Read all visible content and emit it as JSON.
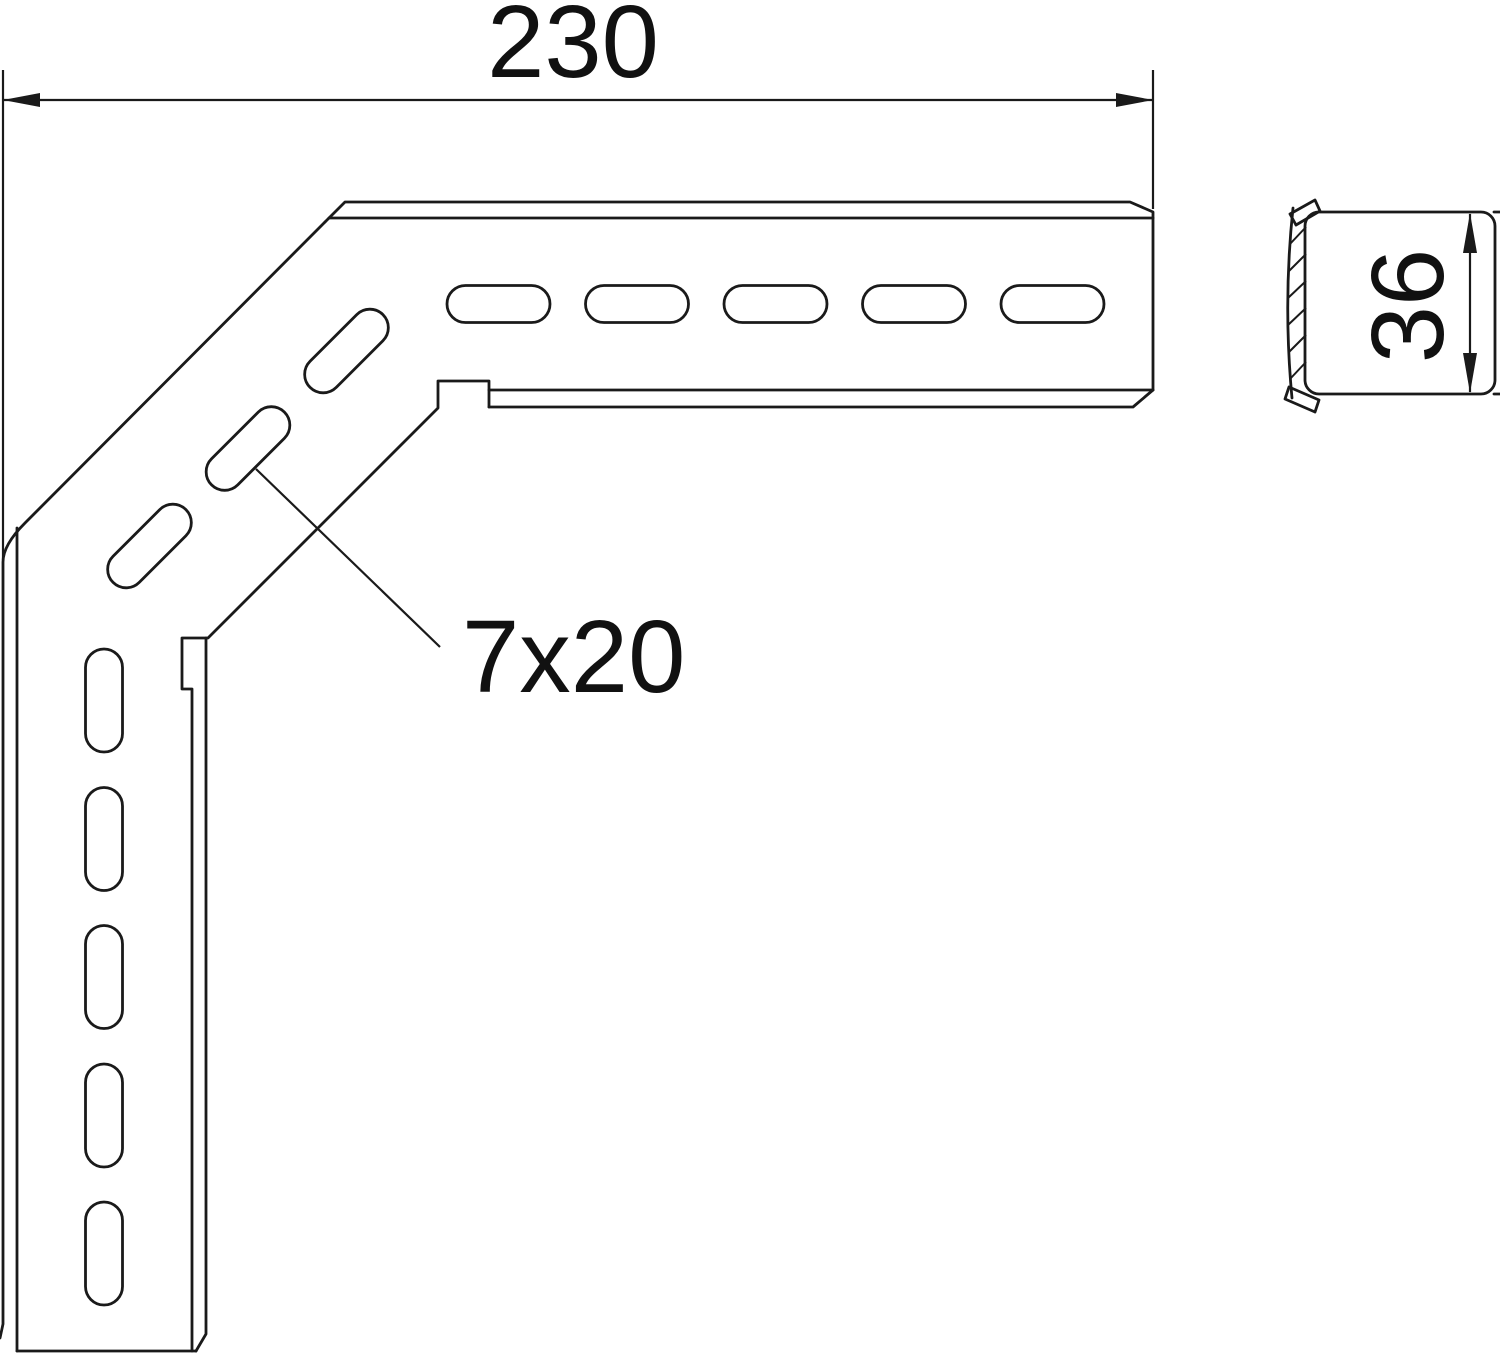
{
  "drawing": {
    "type": "technical-drawing",
    "part": "corner-bracket-with-slotted-holes",
    "views": {
      "front": "angled-bracket-front-view",
      "side": "channel-profile-side-view"
    },
    "dimensions": {
      "overall_width_label": "230",
      "slot_size_label": "7x20",
      "profile_height_label": "36"
    },
    "slots": {
      "horizontal_count": 5,
      "diagonal_count": 3,
      "vertical_count": 5
    },
    "colors": {
      "background": "#ffffff",
      "line": "#1a1a1a",
      "text": "#111111"
    }
  }
}
